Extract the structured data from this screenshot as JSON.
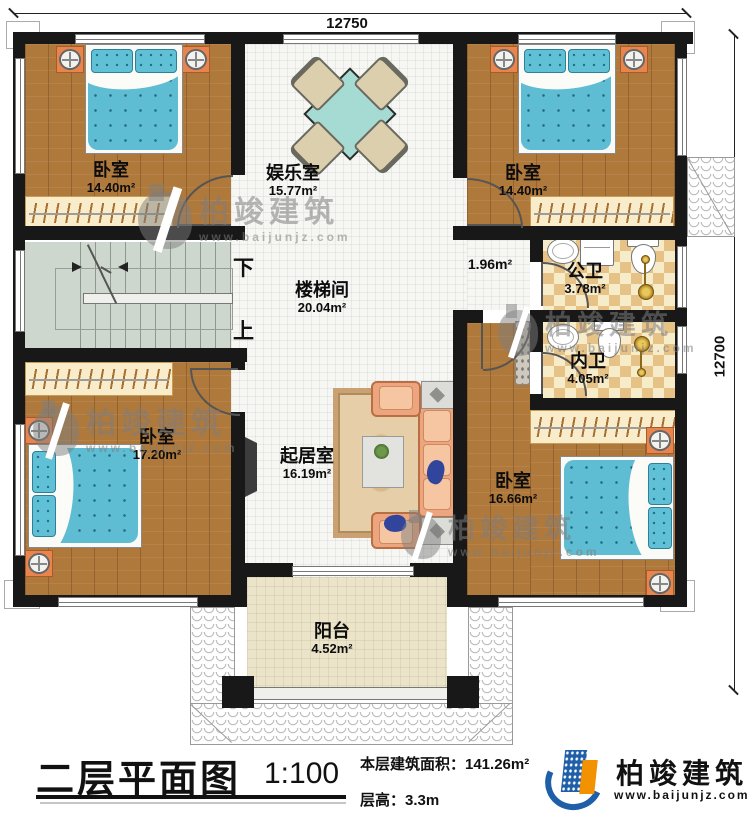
{
  "plan": {
    "dim_top": "12750",
    "dim_right": "12700",
    "rooms": {
      "bedroom_tl": {
        "name": "卧室",
        "area": "14.40m²"
      },
      "entertainment": {
        "name": "娱乐室",
        "area": "15.77m²"
      },
      "bedroom_tr": {
        "name": "卧室",
        "area": "14.40m²"
      },
      "stairwell": {
        "name": "楼梯间",
        "area": "20.04m²"
      },
      "hallway": {
        "area": "1.96m²"
      },
      "public_bath": {
        "name": "公卫",
        "area": "3.78m²"
      },
      "inner_bath": {
        "name": "内卫",
        "area": "4.05m²"
      },
      "bedroom_bl": {
        "name": "卧室",
        "area": "17.20m²"
      },
      "living": {
        "name": "起居室",
        "area": "16.19m²"
      },
      "bedroom_br": {
        "name": "卧室",
        "area": "16.66m²"
      },
      "balcony": {
        "name": "阳台",
        "area": "4.52m²"
      }
    },
    "stairs": {
      "down": "下",
      "up": "上"
    }
  },
  "title_block": {
    "title": "二层平面图",
    "scale": "1:100",
    "area_line": "本层建筑面积：141.26m²",
    "height_line": "层高：3.3m",
    "brand": "柏竣建筑",
    "brand_url": "www.baijunjz.com"
  },
  "watermark": {
    "text": "柏竣建筑",
    "url": "www.baijunjz.com"
  },
  "colors": {
    "wall": "#181818",
    "wood": "#b0793c",
    "bath_tile": "#e7c287",
    "stairs": "#cdd7cd",
    "balcony": "#ebe4c9",
    "bedding": "#5ebcd3",
    "nightstand": "#e8854e",
    "brand_blue": "#1e5fa8",
    "brand_orange": "#f29200"
  }
}
